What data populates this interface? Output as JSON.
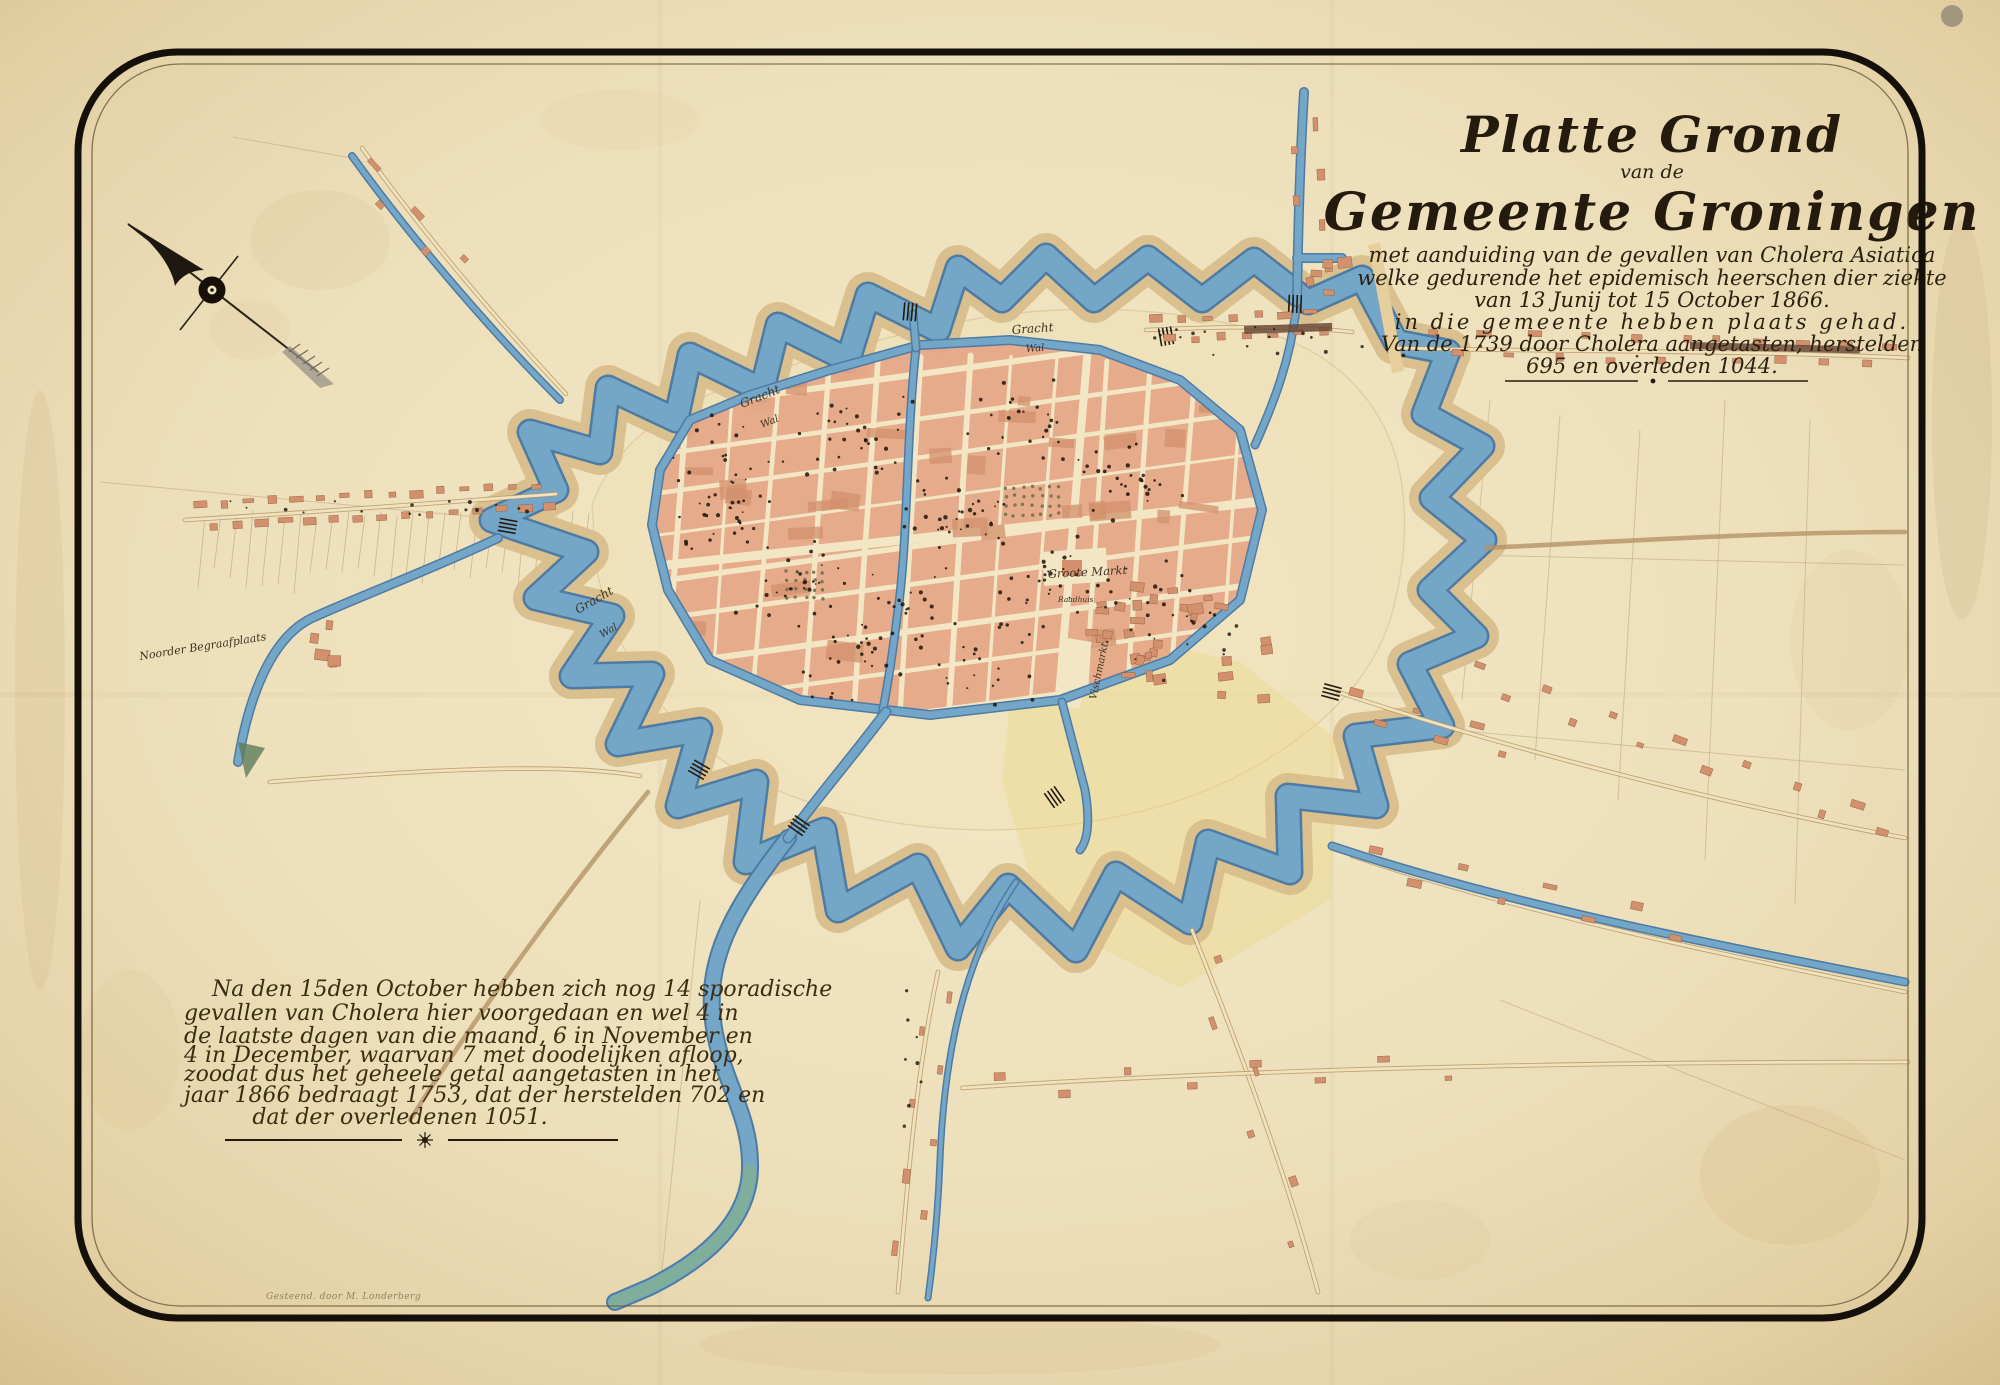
{
  "title_block": {
    "main": [
      "Platte Grond",
      "van de",
      "Gemeente Groningen"
    ],
    "sub": [
      "met aanduiding van de gevallen van Cholera Asiatica",
      "welke gedurende het epidemisch heerschen dier ziekte",
      "van 13 Junij tot 15 October 1866.",
      "in die gemeente hebben plaats gehad.",
      "Van de 1739 door Cholera aangetasten, herstelden",
      "695 en overleden 1044."
    ]
  },
  "note_block": {
    "lines": [
      "Na den 15den October hebben zich nog 14 sporadische",
      "gevallen van Cholera hier voorgedaan en wel 4 in",
      "de laatste dagen van die maand, 6 in November en",
      "4 in December, waarvan 7 met doodelijken afloop,",
      "zoodat dus het geheele getal aangetasten in het",
      "jaar 1866 bedraagt 1753, dat der herstelden 702 en",
      "dat der overledenen 1051."
    ]
  },
  "map_labels": {
    "gracht_n": "Gracht",
    "wal_n": "Wal",
    "gracht_nw": "Gracht",
    "wal_nw": "Wal",
    "gracht_sw": "Gracht",
    "wal_sw": "Wal",
    "groote_markt": "Groote Markt",
    "raadhuis": "Raadhuis",
    "vischmarkt": "Vischmarkt",
    "cemetery": "Noorder Begraafplaats"
  },
  "credits": {
    "printer_credit": "Gesteend. door M. Londerberg"
  },
  "statistics": {
    "afflicted_epidemic": 1739,
    "recovered_epidemic": 695,
    "died_epidemic": 1044,
    "sporadic_cases_after": 14,
    "total_afflicted_1866": 1753,
    "total_recovered": 702,
    "total_died": 1051
  },
  "colors": {
    "paper": "#eee0ba",
    "paper_edge": "#d8c190",
    "ink": "#241a0e",
    "water": "#74a6c8",
    "water_edge": "#4e7ba3",
    "rampart_band": "#d8bd8a",
    "building": "#e5a687",
    "building_accent": "#d2906c",
    "road": "#f0e2ba",
    "label_ink": "#3e3322"
  }
}
